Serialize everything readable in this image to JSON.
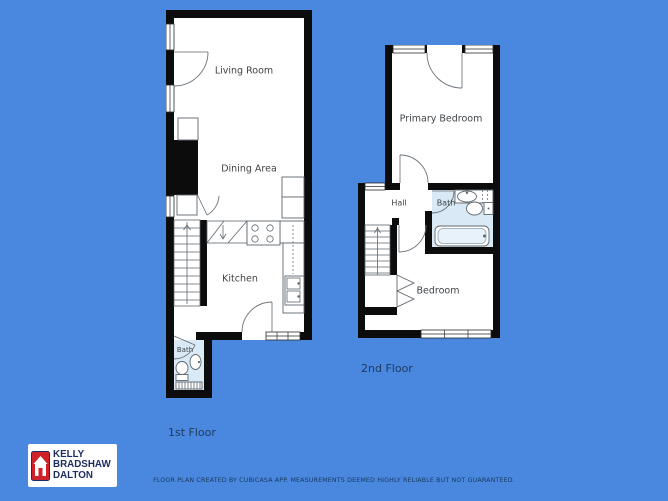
{
  "colors": {
    "background": "#4a87de",
    "wall": "#0c0c0c",
    "bath_floor": "#d9eaf6",
    "logo_red": "#d02028",
    "logo_navy": "#1d2c5e",
    "caption_navy": "#1f3b60"
  },
  "floors": {
    "first": {
      "caption": "1st Floor",
      "rooms": {
        "living": "Living Room",
        "dining": "Dining Area",
        "kitchen": "Kitchen",
        "bath": "Bath"
      }
    },
    "second": {
      "caption": "2nd Floor",
      "rooms": {
        "primary": "Primary Bedroom",
        "hall": "Hall",
        "bath": "Bath",
        "bedroom": "Bedroom"
      }
    }
  },
  "logo": {
    "lines": [
      "KELLY",
      "BRADSHAW",
      "DALTON"
    ]
  },
  "footer": {
    "disclaimer": "FLOOR PLAN CREATED BY CUBICASA APP. MEASUREMENTS DEEMED HIGHLY RELIABLE BUT NOT GUARANTEED."
  }
}
